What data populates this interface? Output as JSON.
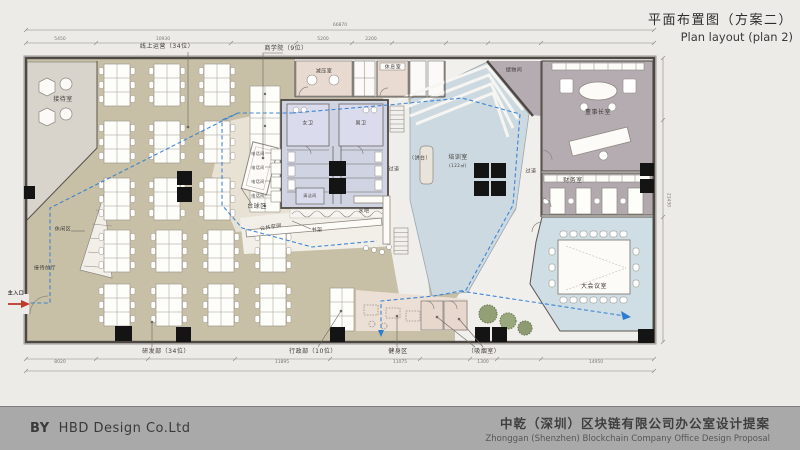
{
  "title": {
    "zh": "平面布置图（方案二）",
    "en": "Plan layout (plan 2)"
  },
  "footer": {
    "by": "BY",
    "company": "HBD Design Co.Ltd",
    "proposal_zh": "中乾（深圳）区块链有限公司办公室设计提案",
    "proposal_en": "Zhonggan (Shenzhen) Blockchain Company Office Design Proposal"
  },
  "rooms": {
    "reception": "接待室",
    "online_ops": "线上运营（34位）",
    "business_school": "商学院（9位）",
    "decompression": "减压室",
    "rest_room": "休息室",
    "storage": "储物间",
    "chairman": "董事长室",
    "finance": "财务室",
    "conference": "大会议室",
    "training": "培训室",
    "training_area": "(122㎡)",
    "podium": "（讲台）",
    "corridor": "过道",
    "billiards": "台球区",
    "womens_wc": "女卫",
    "mens_wc": "男卫",
    "cleaning": "清洁间",
    "phone_booth": "电话间",
    "water_bar": "水吧",
    "bookshelf": "书架",
    "public_space": "公共空间",
    "leisure": "休闲区",
    "lobby": "接待前厅",
    "rnd": "研发部（34位）",
    "admin": "行政部（10位）",
    "fitness": "健身区",
    "smoking": "（吸烟室）",
    "entrance": "主入口"
  },
  "dimensions": {
    "top": [
      "66870",
      "5450",
      "10930",
      "5200",
      "2200"
    ],
    "bottom": [
      "8020",
      "11895",
      "11075",
      "1300",
      "14950"
    ],
    "right": [
      "21430"
    ]
  },
  "colors": {
    "route_blue": "#2e7cd1",
    "wall": "#4d4843",
    "tan_floor": "#c7c0a6",
    "mauve_floor": "#b5acb2",
    "training_blue": "#cdd9e0",
    "core_blue": "#d0d4e2",
    "conference_blue": "#cfdde4",
    "fitness_pink": "#ecdfd6",
    "entrance_red": "#c0392b",
    "footer_gray": "#a9a9a9"
  }
}
